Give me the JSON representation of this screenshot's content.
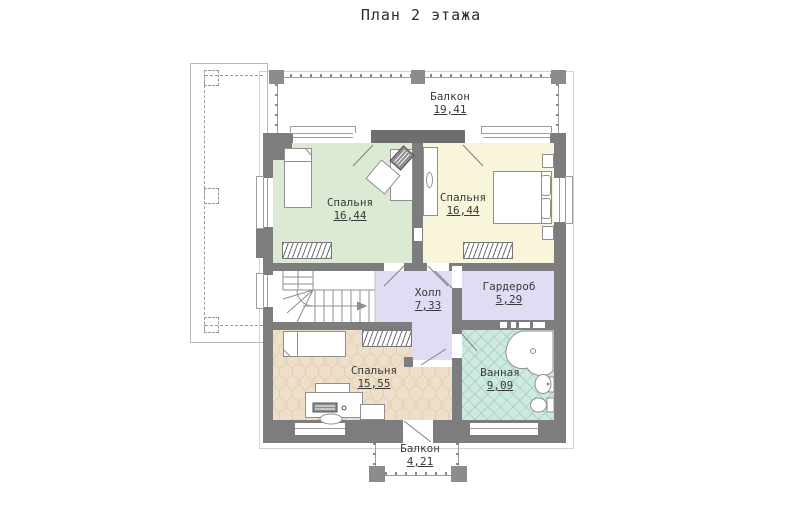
{
  "title": "План 2 этажа",
  "rooms": {
    "balcony_top": {
      "name": "Балкон",
      "area": "19,41"
    },
    "bedroom_left": {
      "name": "Спальня",
      "area": "16,44"
    },
    "bedroom_right": {
      "name": "Спальня",
      "area": "16,44"
    },
    "hall": {
      "name": "Холл",
      "area": "7,33"
    },
    "wardrobe": {
      "name": "Гардероб",
      "area": "5,29"
    },
    "bedroom_bottom": {
      "name": "Спальня",
      "area": "15,55"
    },
    "bathroom": {
      "name": "Ванная",
      "area": "9,09"
    },
    "balcony_bottom": {
      "name": "Балкон",
      "area": "4,21"
    }
  },
  "colors": {
    "wall": "#7d7d7d",
    "wall_header": "#6e6e6e",
    "bedroom_green": "#dcead4",
    "bedroom_cream": "#f8f5da",
    "hall_lavender": "#dfddf3",
    "bedroom_tan": "#eedfca",
    "bathroom_teal": "#cfe9e1",
    "text": "#3a3a3a"
  }
}
